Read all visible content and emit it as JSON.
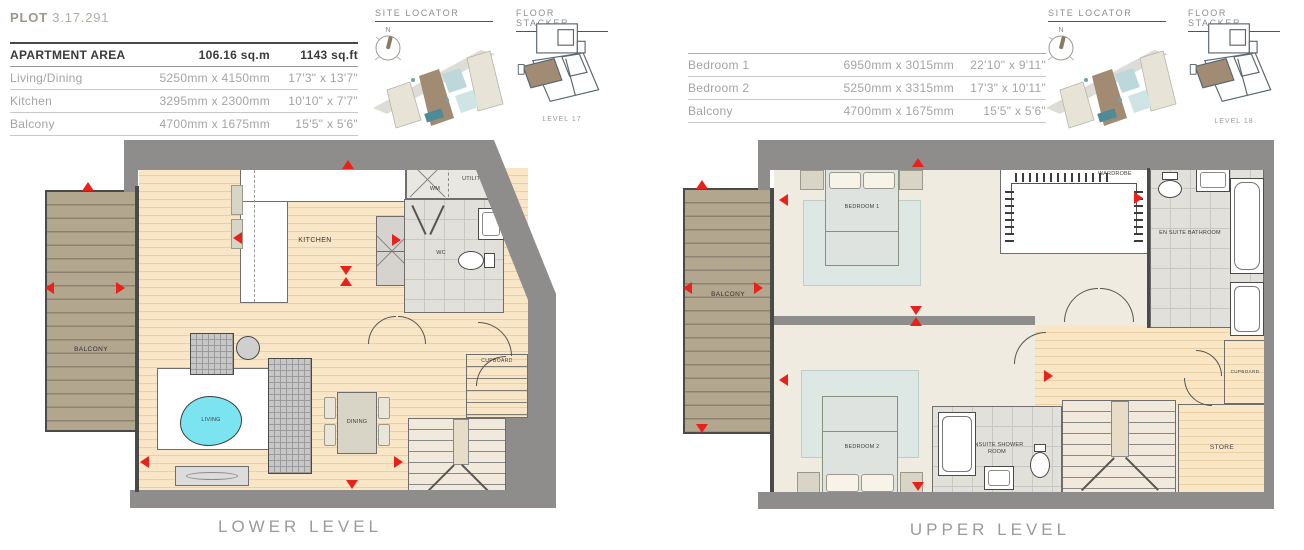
{
  "plot": {
    "label": "PLOT",
    "number": "3.17.291"
  },
  "apartment_table": {
    "header": {
      "name": "APARTMENT AREA",
      "metric": "106.16 sq.m",
      "imperial": "1143 sq.ft"
    },
    "rows": [
      {
        "name": "Living/Dining",
        "metric": "5250mm x 4150mm",
        "imperial": "17'3\" x 13'7\""
      },
      {
        "name": "Kitchen",
        "metric": "3295mm x 2300mm",
        "imperial": "10'10\" x 7'7\""
      },
      {
        "name": "Balcony",
        "metric": "4700mm x 1675mm",
        "imperial": "15'5\" x 5'6\""
      }
    ]
  },
  "bedroom_table": {
    "rows": [
      {
        "name": "Bedroom 1",
        "metric": "6950mm x 3015mm",
        "imperial": "22'10\" x 9'11\""
      },
      {
        "name": "Bedroom 2",
        "metric": "5250mm x 3315mm",
        "imperial": "17'3\" x 10'11\""
      },
      {
        "name": "Balcony",
        "metric": "4700mm x 1675mm",
        "imperial": "15'5\" x 5'6\""
      }
    ]
  },
  "locators": {
    "site_title": "SITE LOCATOR",
    "stacker_title": "FLOOR STACKER",
    "compass": "N",
    "left_level": "LEVEL 17",
    "right_level": "LEVEL 18"
  },
  "lower_plan": {
    "title": "LOWER LEVEL",
    "rooms": {
      "balcony": "BALCONY",
      "kitchen": "KITCHEN",
      "wm": "WM",
      "utility": "UTILITY",
      "wc": "WC",
      "living": "LIVING",
      "dining": "DINING",
      "cupboard": "CUPBOARD"
    }
  },
  "upper_plan": {
    "title": "UPPER LEVEL",
    "rooms": {
      "balcony": "BALCONY",
      "bedroom1": "BEDROOM 1",
      "wardrobe": "WARDROBE",
      "ensuite_bathroom": "EN SUITE BATHROOM",
      "bedroom2": "BEDROOM 2",
      "ensuite_shower": "ENSUITE SHOWER ROOM",
      "store": "STORE",
      "cupboard": "CUPBOARD"
    }
  },
  "colors": {
    "marker_red": "#e8221a",
    "wall_gray": "#8e8d8b",
    "wood_floor": "#f8e6c6",
    "balcony_deck": "#b3a68e",
    "living_rug": "#7ce4f0",
    "highlight_brown": "#a18b73"
  }
}
